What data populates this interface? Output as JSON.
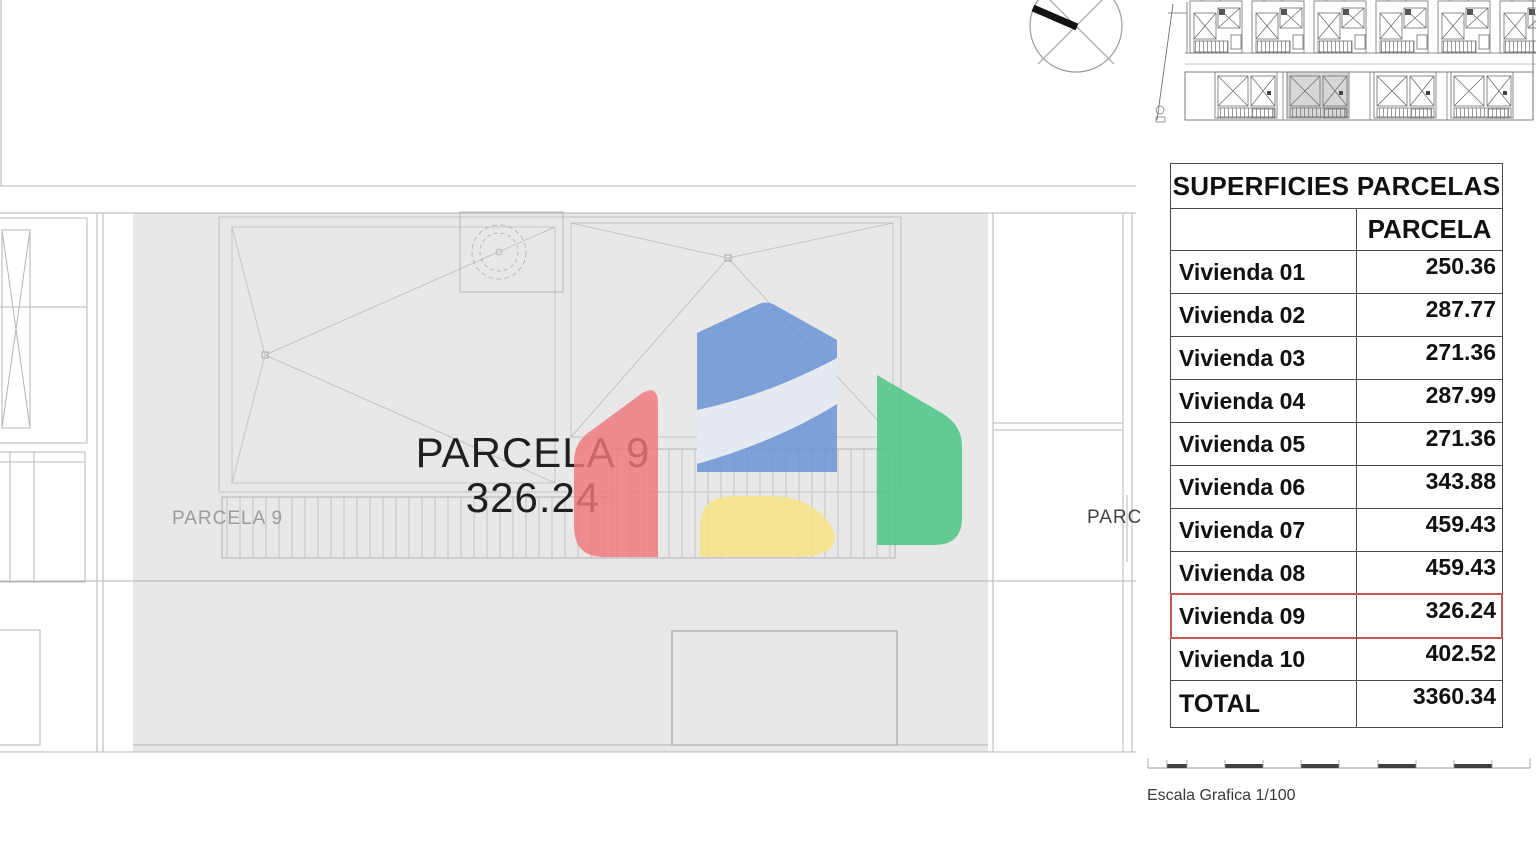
{
  "main_plan": {
    "parcel_title": "PARCELA 9",
    "parcel_area": "326.24",
    "parcel_small_label": "PARCELA 9",
    "neighbor_label": "PARC",
    "scale_caption": "Escala Grafica 1/100"
  },
  "table": {
    "title": "SUPERFICIES PARCELAS",
    "value_column_header": "PARCELA",
    "rows": [
      {
        "label": "Vivienda 01",
        "value": "250.36"
      },
      {
        "label": "Vivienda 02",
        "value": "287.77"
      },
      {
        "label": "Vivienda 03",
        "value": "271.36"
      },
      {
        "label": "Vivienda 04",
        "value": "287.99"
      },
      {
        "label": "Vivienda 05",
        "value": "271.36"
      },
      {
        "label": "Vivienda 06",
        "value": "343.88"
      },
      {
        "label": "Vivienda 07",
        "value": "459.43"
      },
      {
        "label": "Vivienda 08",
        "value": "459.43"
      },
      {
        "label": "Vivienda 09",
        "value": "326.24",
        "highlighted": true
      },
      {
        "label": "Vivienda 10",
        "value": "402.52"
      },
      {
        "label": "TOTAL",
        "value": "3360.34"
      }
    ]
  },
  "colors": {
    "parcel_fill": "#e8e8e8",
    "highlight_red": "#c05a50",
    "watermark_red": "#ef767b",
    "watermark_blue": "#6b93d6",
    "watermark_green": "#4fc687",
    "watermark_yellow": "#f5e38a"
  }
}
